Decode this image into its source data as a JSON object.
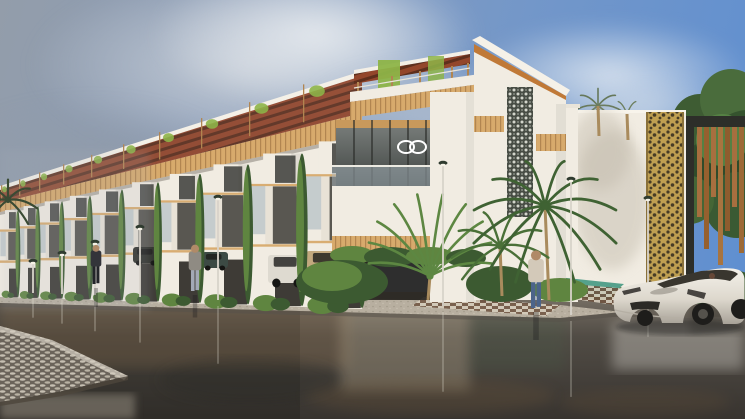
{
  "palette": {
    "sky_top_left": "#939daa",
    "sky_top_right": "#5d8ed1",
    "cloud_light": "#e4e8ec",
    "cloud_dark": "#99a3af",
    "wall_white": "#f1ece2",
    "wall_shade": "#ded7ca",
    "wood": "#d7aa6c",
    "wood_dark": "#b18550",
    "pergola_red": "#93462b",
    "pergola_dark": "#5e2f1d",
    "green_bright": "#8db448",
    "green_mid": "#5f8540",
    "green_dark": "#3c5a31",
    "palm_green": "#4c7539",
    "lattice_dark": "#474c44",
    "jali_gold": "#bf9f51",
    "gate_frame": "#2d2e29",
    "gate_wood": "#a76f3f",
    "glass_dark": "#50554f",
    "glass_blue": "#a9b8c0",
    "street_light": "#7b7368",
    "street": "#514c45",
    "street_dark": "#383430",
    "puddle_brown": "#6f5639",
    "cobble": "#b2ab9e",
    "cobble_joint": "#6a635a",
    "sidewalk": "#b8afa0",
    "teal_path": "#55a18c",
    "checker_brown": "#6f5340",
    "checker_cream": "#d7cdbc",
    "car_white": "#eae6dd",
    "car_shade": "#aaa49a",
    "car_glass": "#39362f"
  },
  "scene": {
    "row": {
      "boundaries": [
        0,
        18,
        38,
        62,
        90,
        122,
        158,
        200,
        248,
        302,
        362
      ],
      "levels": {
        "base": [
          297,
          309
        ],
        "ground_top": [
          262,
          240
        ],
        "upper_top": [
          232,
          170
        ],
        "fascia_bottom": [
          212,
          135
        ],
        "fascia_top": [
          203,
          115
        ],
        "pergola_top": [
          188,
          75
        ]
      }
    },
    "lamps": [
      {
        "x": 33,
        "top": 259,
        "base": 293
      },
      {
        "x": 62,
        "top": 251,
        "base": 294
      },
      {
        "x": 95,
        "top": 240,
        "base": 295
      },
      {
        "x": 140,
        "top": 225,
        "base": 297
      },
      {
        "x": 218,
        "top": 195,
        "base": 300
      },
      {
        "x": 443,
        "top": 161,
        "base": 306
      },
      {
        "x": 571,
        "top": 177,
        "base": 315
      },
      {
        "x": 648,
        "top": 196,
        "base": 283
      }
    ],
    "people": [
      {
        "x": 96,
        "base": 284,
        "h": 38,
        "top": "#33343a",
        "legs": "#23242a",
        "skin": "#b08a68"
      },
      {
        "x": 195,
        "base": 291,
        "h": 45,
        "top": "#8f8b83",
        "legs": "#a3a9b6",
        "skin": "#b08a68"
      },
      {
        "x": 536,
        "base": 308,
        "h": 56,
        "top": "#d3c9b9",
        "legs": "#4c648a",
        "skin": "#b08a68"
      }
    ],
    "garage_cars": [
      {
        "x": 133,
        "y": 247,
        "w": 26,
        "h": 16,
        "color": "#32332e"
      },
      {
        "x": 202,
        "y": 252,
        "w": 26,
        "h": 16,
        "color": "#3c4a44"
      },
      {
        "x": 268,
        "y": 255,
        "w": 38,
        "h": 28,
        "color": "#dedad0"
      },
      {
        "x": 306,
        "y": 251,
        "w": 46,
        "h": 27,
        "color": "#c2a87e"
      }
    ],
    "palms": [
      {
        "cx": 8,
        "cy": 200,
        "len": 34,
        "spread": 250,
        "n": 7,
        "color": "#3a4a33",
        "droop": 0.8,
        "w": 2.2
      },
      {
        "cx": 598,
        "cy": 106,
        "len": 27,
        "spread": 330,
        "n": 9,
        "color": "#66785a",
        "droop": 0.7,
        "w": 1.6
      },
      {
        "cx": 627,
        "cy": 114,
        "len": 22,
        "spread": 330,
        "n": 8,
        "color": "#6d7f5e",
        "droop": 0.7,
        "w": 1.4
      },
      {
        "cx": 430,
        "cy": 276,
        "len": 88,
        "spread": 150,
        "n": 10,
        "color": "#5d8742",
        "droop": 0.12,
        "w": 2.6
      },
      {
        "cx": 500,
        "cy": 246,
        "len": 58,
        "spread": 230,
        "n": 8,
        "color": "#4a7038",
        "droop": 0.75,
        "w": 2.4
      },
      {
        "cx": 545,
        "cy": 206,
        "len": 82,
        "spread": 300,
        "n": 12,
        "color": "#3f6233",
        "droop": 0.85,
        "w": 2.8
      }
    ],
    "trunks": [
      {
        "x1": 430,
        "y1": 276,
        "x2": 428,
        "y2": 300
      },
      {
        "x1": 500,
        "y1": 246,
        "x2": 502,
        "y2": 296
      },
      {
        "x1": 545,
        "y1": 206,
        "x2": 549,
        "y2": 300
      },
      {
        "x1": 598,
        "y1": 106,
        "x2": 599,
        "y2": 136
      },
      {
        "x1": 627,
        "y1": 114,
        "x2": 628,
        "y2": 140
      }
    ]
  }
}
